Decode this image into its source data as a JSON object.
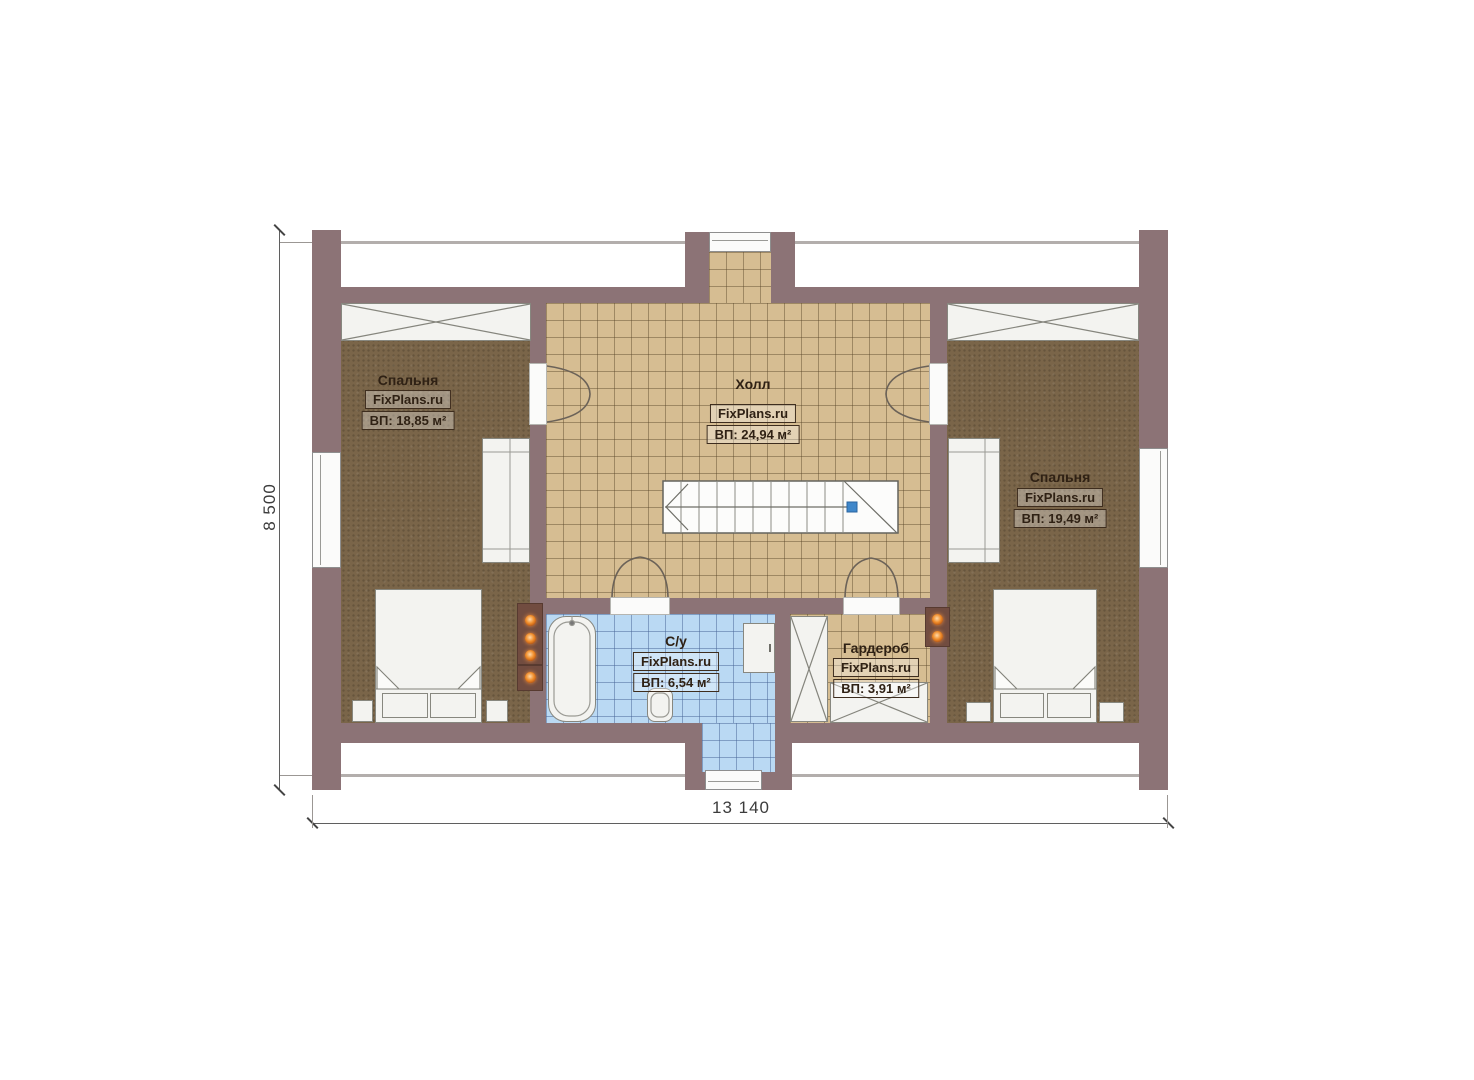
{
  "plan": {
    "dimensions": {
      "height_label": "8 500",
      "width_label": "13 140"
    },
    "rooms": {
      "bedroom_left": {
        "name": "Спальня",
        "watermark": "FixPlans.ru",
        "area": "ВП: 18,85 м²"
      },
      "hall": {
        "name": "Холл",
        "watermark": "FixPlans.ru",
        "area": "ВП: 24,94 м²"
      },
      "bedroom_right": {
        "name": "Спальня",
        "watermark": "FixPlans.ru",
        "area": "ВП: 19,49 м²"
      },
      "bathroom": {
        "name": "С/у",
        "watermark": "FixPlans.ru",
        "area": "ВП: 6,54 м²"
      },
      "wardrobe": {
        "name": "Гардероб",
        "watermark": "FixPlans.ru",
        "area": "ВП: 3,91 м²"
      }
    },
    "colors": {
      "wall": "#8c7376",
      "bedroom_floor": "#7a6549",
      "hall_floor": "#d6bd92",
      "bath_floor": "#bad9f3",
      "chimney": "#714c40",
      "flue_dot": "#ef8c2a",
      "stair_handle": "#3f87ca"
    }
  }
}
